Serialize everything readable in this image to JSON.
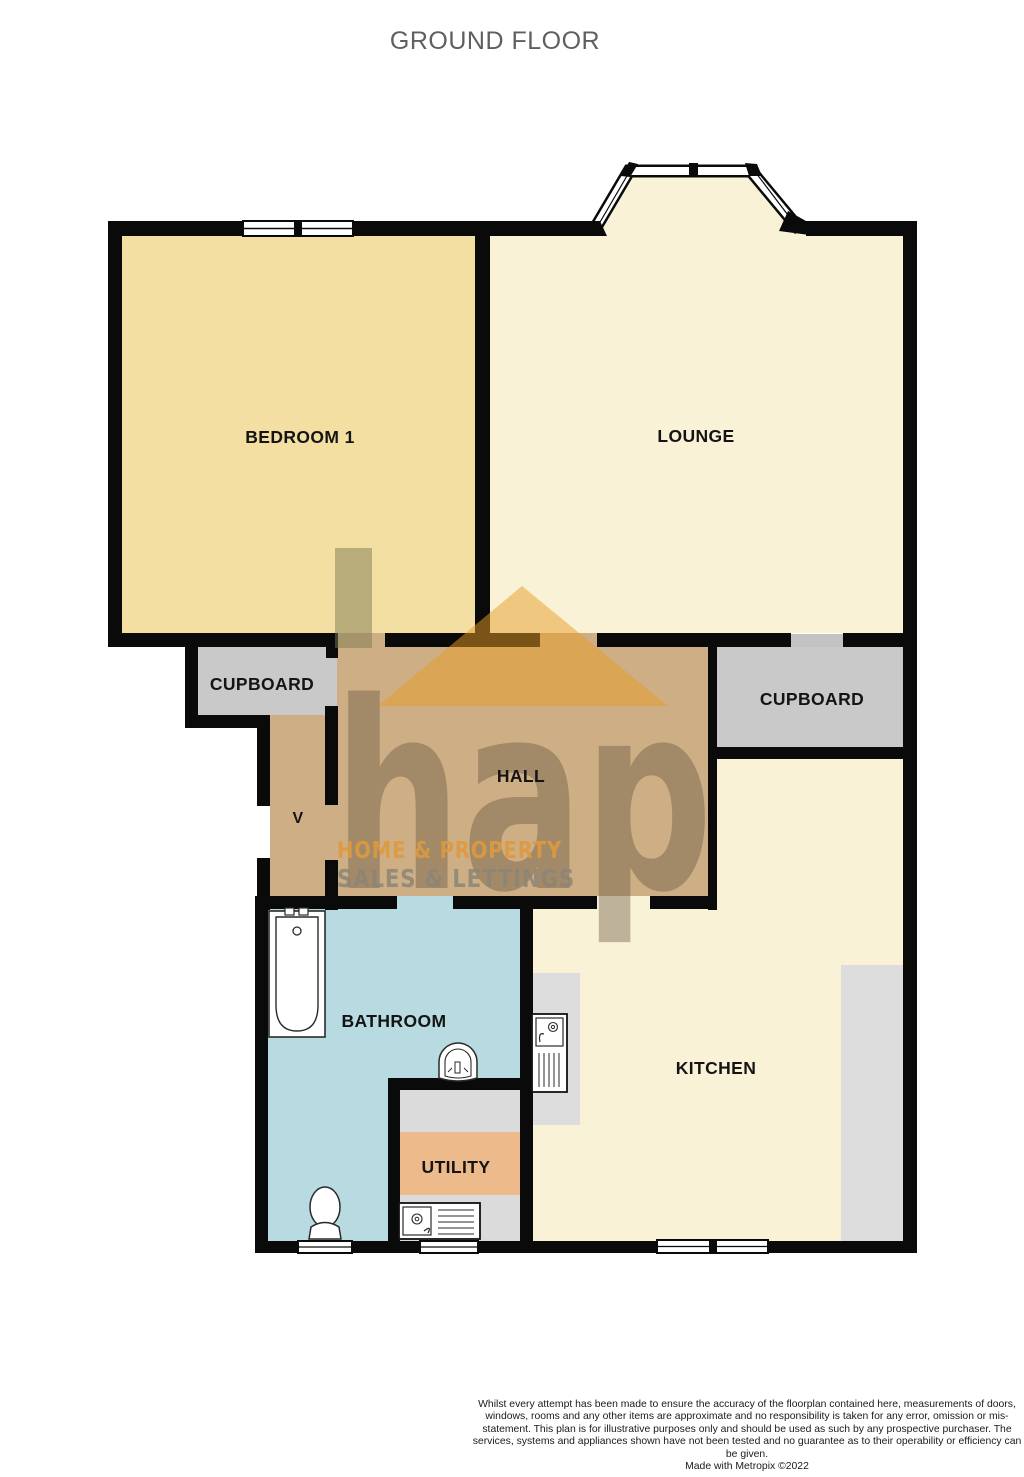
{
  "title": "GROUND FLOOR",
  "rooms": {
    "bedroom1": {
      "label": "BEDROOM 1"
    },
    "lounge": {
      "label": "LOUNGE"
    },
    "cupboard_left": {
      "label": "CUPBOARD"
    },
    "cupboard_right": {
      "label": "CUPBOARD"
    },
    "hall": {
      "label": "HALL"
    },
    "vestibule": {
      "label": "V"
    },
    "bathroom": {
      "label": "BATHROOM"
    },
    "utility": {
      "label": "UTILITY"
    },
    "kitchen": {
      "label": "KITCHEN"
    }
  },
  "watermark": {
    "logo": "hap",
    "line1": "HOME & PROPERTY",
    "line2": "SALES & LETTINGS"
  },
  "footer": {
    "disclaimer": "Whilst every attempt has been made to ensure the accuracy of the floorplan contained here, measurements of doors, windows, rooms and any other items are approximate and no responsibility is taken for any error, omission or mis-statement. This plan is for illustrative purposes only and should be used as such by any prospective purchaser. The services, systems and appliances shown have not been tested and no guarantee as to their operability or efficiency can be given.",
    "credit": "Made with Metropix ©2022"
  },
  "colors": {
    "wall": "#0a0a0a",
    "bedroom_fill": "#F3DFA2",
    "lounge_kitchen_fill": "#F9F2D7",
    "hall_fill": "#CDAE85",
    "bathroom_fill": "#B7DBE0",
    "utility_fill": "#EDBA8C",
    "cupboard_fill": "#C9C9C9",
    "counter_fill": "#DDDDDD",
    "watermark_orange": "#E89C26",
    "watermark_text_orange": "#DE9A3E",
    "watermark_gray": "#8C8577",
    "title_color": "#5f5f5f"
  }
}
